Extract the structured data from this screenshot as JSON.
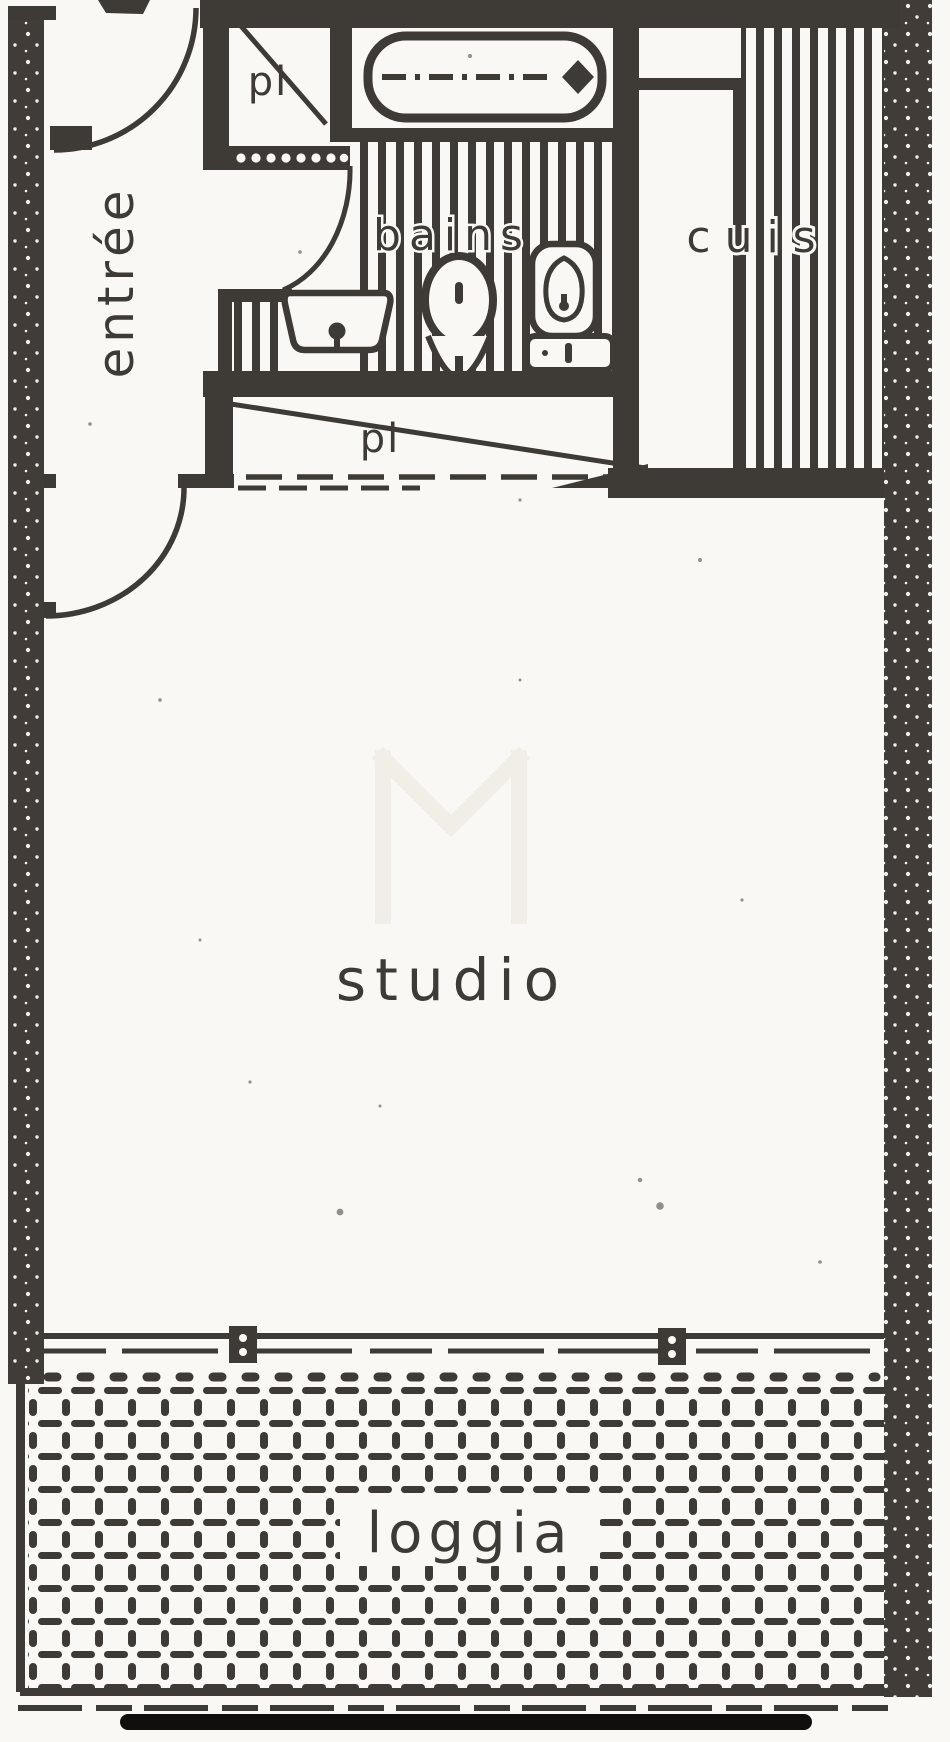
{
  "document": {
    "kind": "scanned apartment floor plan"
  },
  "rooms": {
    "entrance": {
      "label": "entrée"
    },
    "closet_entry": {
      "label": "pl"
    },
    "bathroom": {
      "label": "bains"
    },
    "kitchen": {
      "label": "cuis"
    },
    "closet_hall": {
      "label": "pl"
    },
    "studio": {
      "label": "studio"
    },
    "loggia": {
      "label": "loggia"
    }
  },
  "fixtures": {
    "bathtub": "bathtub",
    "sink": "washbasin",
    "toilet": "toilet",
    "bidet": "bidet"
  },
  "colors": {
    "ink": "#3e3a36",
    "wall": "#413c38",
    "paper": "#faf8f4",
    "watermark": "#f1eee7"
  }
}
